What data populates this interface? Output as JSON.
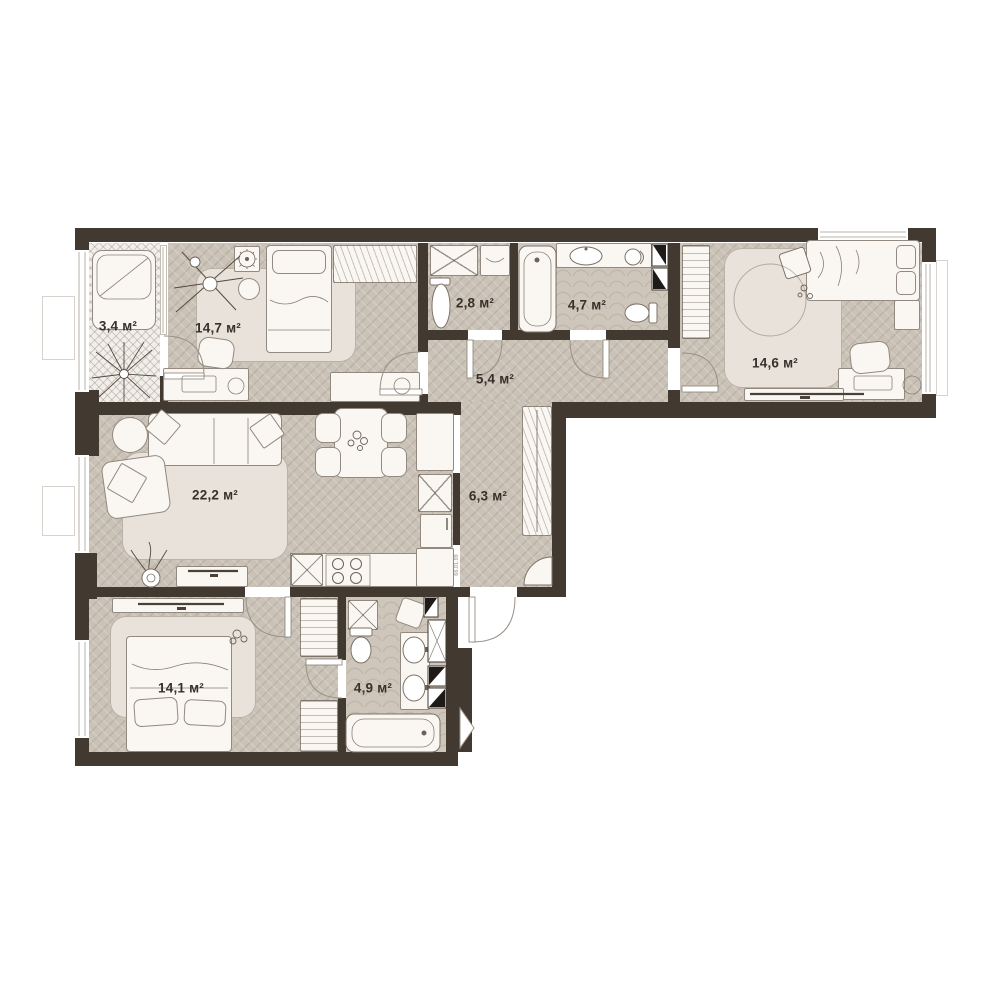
{
  "plan": {
    "title": "apartment floor plan",
    "unit_suffix": "м²",
    "rooms": [
      {
        "id": "balcony",
        "label": "3,4 м²",
        "area": "3,4"
      },
      {
        "id": "bedroom-top-left",
        "label": "14,7 м²",
        "area": "14,7"
      },
      {
        "id": "wc",
        "label": "2,8 м²",
        "area": "2,8"
      },
      {
        "id": "bathroom-top",
        "label": "4,7 м²",
        "area": "4,7"
      },
      {
        "id": "hallway-top",
        "label": "5,4 м²",
        "area": "5,4"
      },
      {
        "id": "bedroom-top-right",
        "label": "14,6 м²",
        "area": "14,6"
      },
      {
        "id": "living-room",
        "label": "22,2 м²",
        "area": "22,2"
      },
      {
        "id": "hallway-main",
        "label": "6,3 м²",
        "area": "6,3"
      },
      {
        "id": "bedroom-bottom-left",
        "label": "14,1 м²",
        "area": "14,1"
      },
      {
        "id": "bathroom-bottom",
        "label": "4,9 м²",
        "area": "4,9"
      }
    ],
    "annotations": {
      "door_marking": "66.01.99"
    },
    "colors": {
      "wall": "#423930",
      "floor": "#cbc2b7",
      "floor_bath": "#cfc6bb",
      "balcony_floor": "#f2efea",
      "rug": "#e8e2da",
      "furniture": "#faf7f3",
      "label_text": "#38302a"
    }
  }
}
